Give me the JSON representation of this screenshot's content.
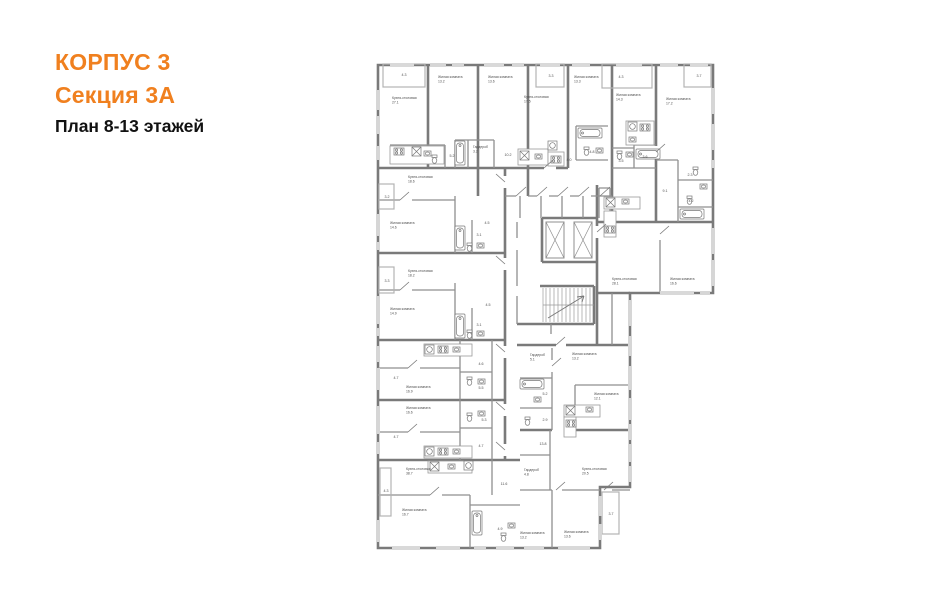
{
  "title": {
    "line1": "КОРПУС 3",
    "line2": "Секция 3А",
    "line3": "План 8-13 этажей",
    "accent_color": "#F0801F"
  },
  "plan": {
    "wall_color": "#7a7a7a",
    "thin_color": "#8f8f8f",
    "label_color": "#4e4e4e",
    "rooms": [
      {
        "n": "Кухня-столовая",
        "a": "27.1",
        "x": 392,
        "y": 99
      },
      {
        "n": "Жилая комната",
        "a": "13.2",
        "x": 438,
        "y": 78
      },
      {
        "n": "Жилая комната",
        "a": "13.6",
        "x": 488,
        "y": 78
      },
      {
        "n": "Кухня-столовая",
        "a": "17.5",
        "x": 524,
        "y": 98
      },
      {
        "n": "Жилая комната",
        "a": "13.3",
        "x": 574,
        "y": 78
      },
      {
        "n": "Жилая комната",
        "a": "14.3",
        "x": 616,
        "y": 96
      },
      {
        "n": "Жилая комната",
        "a": "17.2",
        "x": 666,
        "y": 100
      },
      {
        "n": "Кухня-столовая",
        "a": "18.6",
        "x": 408,
        "y": 178
      },
      {
        "n": "Жилая комната",
        "a": "14.6",
        "x": 390,
        "y": 224
      },
      {
        "n": "Кухня-столовая",
        "a": "18.2",
        "x": 408,
        "y": 272
      },
      {
        "n": "Жилая комната",
        "a": "14.9",
        "x": 390,
        "y": 310
      },
      {
        "n": "Кухня-столовая",
        "a": "28.1",
        "x": 612,
        "y": 280
      },
      {
        "n": "Жилая комната",
        "a": "16.6",
        "x": 670,
        "y": 280
      },
      {
        "n": "Жилая комната",
        "a": "16.9",
        "x": 406,
        "y": 388
      },
      {
        "n": "Жилая комната",
        "a": "16.6",
        "x": 406,
        "y": 409
      },
      {
        "n": "Кухня-столовая",
        "a": "38.7",
        "x": 406,
        "y": 470
      },
      {
        "n": "Жилая комната",
        "a": "16.7",
        "x": 402,
        "y": 511
      },
      {
        "n": "Гардероб",
        "a": "5.1",
        "x": 530,
        "y": 356
      },
      {
        "n": "Жилая комната",
        "a": "13.2",
        "x": 572,
        "y": 355
      },
      {
        "n": "Жилая комната",
        "a": "12.1",
        "x": 594,
        "y": 395
      },
      {
        "n": "Гардероб",
        "a": "4.8",
        "x": 524,
        "y": 471
      },
      {
        "n": "Кухня-столовая",
        "a": "20.5",
        "x": 582,
        "y": 470
      },
      {
        "n": "Жилая комната",
        "a": "13.2",
        "x": 520,
        "y": 534
      },
      {
        "n": "Жилая комната",
        "a": "13.6",
        "x": 564,
        "y": 533
      },
      {
        "n": "Гардероб",
        "a": "3.2",
        "x": 473,
        "y": 148
      }
    ],
    "areas": [
      {
        "a": "4.3",
        "x": 404,
        "y": 76
      },
      {
        "a": "3.3",
        "x": 551,
        "y": 77
      },
      {
        "a": "4.3",
        "x": 621,
        "y": 78
      },
      {
        "a": "3.7",
        "x": 699,
        "y": 77
      },
      {
        "a": "5.2",
        "x": 452,
        "y": 157
      },
      {
        "a": "10.2",
        "x": 508,
        "y": 156
      },
      {
        "a": "4.0",
        "x": 569,
        "y": 161
      },
      {
        "a": "4.8",
        "x": 592,
        "y": 153
      },
      {
        "a": "3.5",
        "x": 621,
        "y": 162
      },
      {
        "a": "3.6",
        "x": 645,
        "y": 158
      },
      {
        "a": "9.1",
        "x": 665,
        "y": 192
      },
      {
        "a": "2.3",
        "x": 690,
        "y": 176
      },
      {
        "a": "4.2",
        "x": 691,
        "y": 202
      },
      {
        "a": "3.2",
        "x": 387,
        "y": 198
      },
      {
        "a": "4.5",
        "x": 487,
        "y": 224
      },
      {
        "a": "3.1",
        "x": 479,
        "y": 236
      },
      {
        "a": "3.3",
        "x": 387,
        "y": 282
      },
      {
        "a": "4.5",
        "x": 488,
        "y": 306
      },
      {
        "a": "3.1",
        "x": 479,
        "y": 326
      },
      {
        "a": "4.6",
        "x": 481,
        "y": 365
      },
      {
        "a": "4.7",
        "x": 396,
        "y": 379
      },
      {
        "a": "5.5",
        "x": 481,
        "y": 389
      },
      {
        "a": "4.7",
        "x": 396,
        "y": 438
      },
      {
        "a": "5.3",
        "x": 484,
        "y": 421
      },
      {
        "a": "4.7",
        "x": 481,
        "y": 447
      },
      {
        "a": "4.3",
        "x": 386,
        "y": 492
      },
      {
        "a": "11.6",
        "x": 504,
        "y": 485
      },
      {
        "a": "4.9",
        "x": 500,
        "y": 530
      },
      {
        "a": "5.2",
        "x": 545,
        "y": 395
      },
      {
        "a": "2.9",
        "x": 545,
        "y": 421
      },
      {
        "a": "13.8",
        "x": 543,
        "y": 445
      },
      {
        "a": "3.7",
        "x": 611,
        "y": 515
      }
    ],
    "windows": {
      "top": {
        "y": 65,
        "runs": [
          [
            390,
            24
          ],
          [
            430,
            16
          ],
          [
            452,
            12
          ],
          [
            484,
            20
          ],
          [
            512,
            12
          ],
          [
            540,
            20
          ],
          [
            572,
            18
          ],
          [
            616,
            26
          ],
          [
            660,
            18
          ],
          [
            690,
            18
          ]
        ]
      },
      "left": {
        "x": 378,
        "runs": [
          [
            90,
            20
          ],
          [
            116,
            18
          ],
          [
            146,
            14
          ],
          [
            214,
            22
          ],
          [
            242,
            8
          ],
          [
            296,
            28
          ],
          [
            328,
            8
          ],
          [
            346,
            16
          ],
          [
            368,
            22
          ],
          [
            406,
            20
          ],
          [
            426,
            8
          ],
          [
            442,
            12
          ],
          [
            520,
            22
          ]
        ]
      },
      "bottom": {
        "y": 548,
        "runs": [
          [
            392,
            28
          ],
          [
            436,
            24
          ],
          [
            474,
            12
          ],
          [
            496,
            18
          ],
          [
            524,
            20
          ],
          [
            558,
            32
          ]
        ]
      },
      "wing_right": {
        "x": 713,
        "runs": [
          [
            88,
            26
          ],
          [
            124,
            26
          ],
          [
            160,
            8
          ],
          [
            228,
            26
          ],
          [
            260,
            26
          ]
        ]
      },
      "wing_bottom": {
        "y": 293,
        "runs": [
          [
            660,
            34
          ],
          [
            700,
            10
          ]
        ]
      },
      "main_right": {
        "x": 630,
        "runs": [
          [
            300,
            26
          ],
          [
            336,
            20
          ],
          [
            366,
            24
          ],
          [
            398,
            22
          ],
          [
            424,
            16
          ],
          [
            444,
            18
          ],
          [
            466,
            16
          ]
        ]
      },
      "lower_right": {
        "x": 600,
        "runs": [
          [
            496,
            20
          ],
          [
            524,
            16
          ]
        ]
      }
    },
    "balconies": [
      [
        383,
        64,
        42,
        23
      ],
      [
        536,
        64,
        28,
        23
      ],
      [
        602,
        64,
        50,
        24
      ],
      [
        684,
        64,
        27,
        23
      ],
      [
        379,
        184,
        15,
        25
      ],
      [
        379,
        267,
        15,
        26
      ],
      [
        380,
        468,
        11,
        48
      ],
      [
        602,
        492,
        17,
        42
      ]
    ],
    "fixtures": [
      {
        "t": "stove",
        "x": 394,
        "y": 148
      },
      {
        "t": "hob",
        "x": 412,
        "y": 147
      },
      {
        "t": "sink",
        "x": 424,
        "y": 151
      },
      {
        "t": "wc",
        "x": 431,
        "y": 155
      },
      {
        "t": "tub-v",
        "x": 455,
        "y": 141
      },
      {
        "t": "hob",
        "x": 520,
        "y": 151
      },
      {
        "t": "sink",
        "x": 535,
        "y": 154
      },
      {
        "t": "stove",
        "x": 551,
        "y": 156
      },
      {
        "t": "wm",
        "x": 548,
        "y": 141
      },
      {
        "t": "tub-h",
        "x": 578,
        "y": 128
      },
      {
        "t": "wc",
        "x": 583,
        "y": 147
      },
      {
        "t": "sink",
        "x": 596,
        "y": 148
      },
      {
        "t": "wm",
        "x": 628,
        "y": 122
      },
      {
        "t": "stove",
        "x": 640,
        "y": 124
      },
      {
        "t": "sink",
        "x": 629,
        "y": 137
      },
      {
        "t": "tub-h",
        "x": 636,
        "y": 149
      },
      {
        "t": "wc",
        "x": 616,
        "y": 151
      },
      {
        "t": "sink",
        "x": 626,
        "y": 152
      },
      {
        "t": "wc",
        "x": 692,
        "y": 167
      },
      {
        "t": "sink",
        "x": 700,
        "y": 184
      },
      {
        "t": "wc",
        "x": 686,
        "y": 196
      },
      {
        "t": "tub-h",
        "x": 680,
        "y": 209
      },
      {
        "t": "hob",
        "x": 606,
        "y": 198
      },
      {
        "t": "sink",
        "x": 622,
        "y": 199
      },
      {
        "t": "stove",
        "x": 605,
        "y": 226
      },
      {
        "t": "tub-v",
        "x": 455,
        "y": 226
      },
      {
        "t": "wc",
        "x": 466,
        "y": 243
      },
      {
        "t": "sink",
        "x": 477,
        "y": 243
      },
      {
        "t": "tub-v",
        "x": 455,
        "y": 314
      },
      {
        "t": "wc",
        "x": 466,
        "y": 330
      },
      {
        "t": "sink",
        "x": 477,
        "y": 331
      },
      {
        "t": "wm",
        "x": 425,
        "y": 345
      },
      {
        "t": "stove",
        "x": 438,
        "y": 346
      },
      {
        "t": "sink",
        "x": 453,
        "y": 347
      },
      {
        "t": "wc",
        "x": 466,
        "y": 377
      },
      {
        "t": "sink",
        "x": 478,
        "y": 379
      },
      {
        "t": "wm",
        "x": 425,
        "y": 447
      },
      {
        "t": "stove",
        "x": 438,
        "y": 448
      },
      {
        "t": "sink",
        "x": 453,
        "y": 449
      },
      {
        "t": "wc",
        "x": 466,
        "y": 413
      },
      {
        "t": "sink",
        "x": 478,
        "y": 411
      },
      {
        "t": "hob",
        "x": 430,
        "y": 462
      },
      {
        "t": "sink",
        "x": 448,
        "y": 464
      },
      {
        "t": "wm",
        "x": 464,
        "y": 461
      },
      {
        "t": "tub-v",
        "x": 472,
        "y": 511
      },
      {
        "t": "wc",
        "x": 500,
        "y": 533
      },
      {
        "t": "sink",
        "x": 508,
        "y": 523
      },
      {
        "t": "tub-h",
        "x": 520,
        "y": 379
      },
      {
        "t": "sink",
        "x": 534,
        "y": 397
      },
      {
        "t": "wc",
        "x": 524,
        "y": 417
      },
      {
        "t": "hob",
        "x": 566,
        "y": 406
      },
      {
        "t": "sink",
        "x": 586,
        "y": 407
      },
      {
        "t": "stove",
        "x": 566,
        "y": 420
      }
    ],
    "counters": [
      [
        390,
        146,
        54,
        18
      ],
      [
        518,
        149,
        30,
        16
      ],
      [
        548,
        152,
        16,
        14
      ],
      [
        626,
        121,
        28,
        24
      ],
      [
        604,
        197,
        36,
        12
      ],
      [
        604,
        211,
        12,
        26
      ],
      [
        564,
        405,
        36,
        12
      ],
      [
        564,
        417,
        12,
        20
      ],
      [
        424,
        344,
        48,
        12
      ],
      [
        424,
        446,
        48,
        12
      ],
      [
        428,
        461,
        44,
        12
      ]
    ],
    "doors": [
      [
        516,
        196,
        526,
        187
      ],
      [
        537,
        196,
        547,
        187
      ],
      [
        558,
        196,
        568,
        187
      ],
      [
        579,
        196,
        589,
        187
      ],
      [
        600,
        196,
        610,
        187
      ],
      [
        505,
        182,
        496,
        174
      ],
      [
        505,
        264,
        496,
        256
      ],
      [
        505,
        352,
        496,
        344
      ],
      [
        505,
        410,
        496,
        402
      ],
      [
        505,
        450,
        496,
        442
      ],
      [
        400,
        200,
        409,
        192
      ],
      [
        400,
        290,
        409,
        282
      ],
      [
        408,
        368,
        417,
        360
      ],
      [
        408,
        432,
        417,
        424
      ],
      [
        430,
        495,
        439,
        487
      ],
      [
        556,
        490,
        565,
        482
      ],
      [
        604,
        490,
        613,
        482
      ],
      [
        552,
        366,
        561,
        358
      ],
      [
        597,
        232,
        606,
        224
      ],
      [
        660,
        234,
        669,
        226
      ],
      [
        656,
        152,
        665,
        144
      ],
      [
        544,
        168,
        553,
        160
      ],
      [
        556,
        345,
        565,
        337
      ]
    ]
  }
}
